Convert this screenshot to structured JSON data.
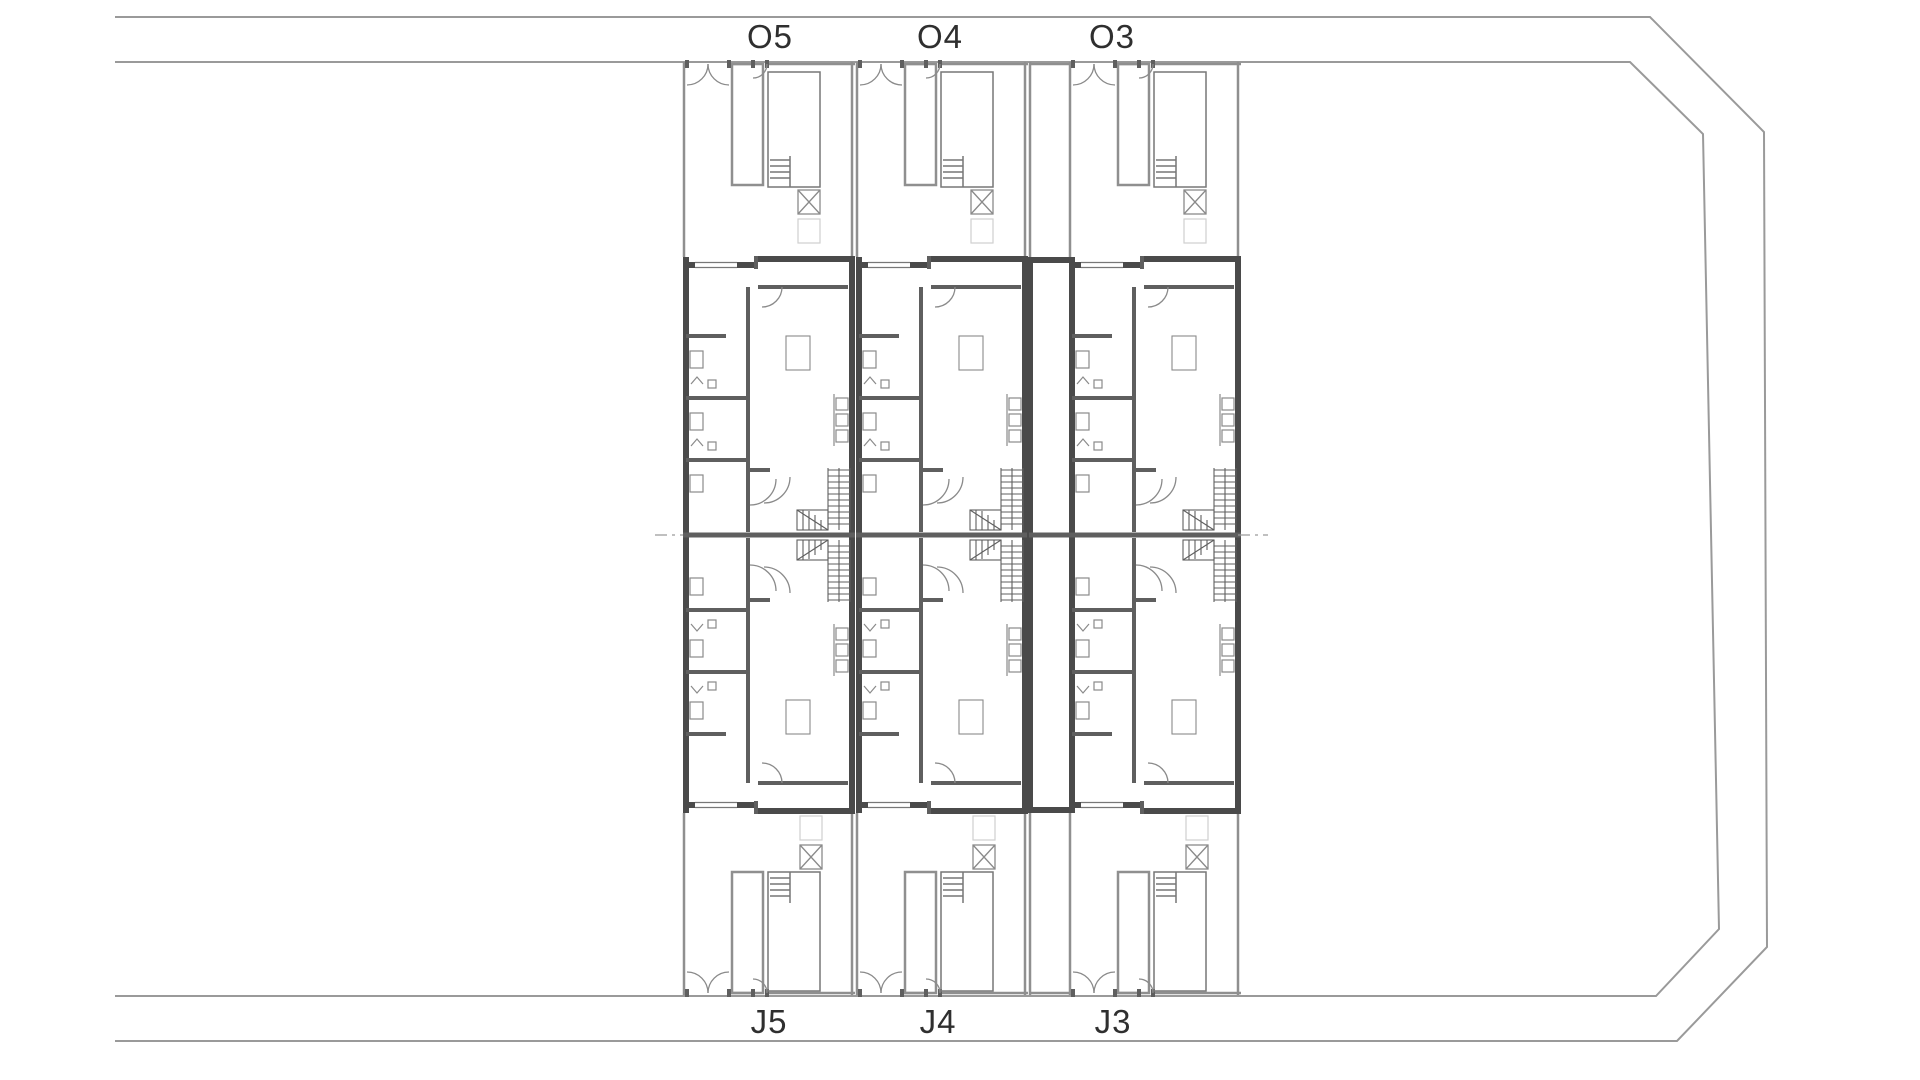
{
  "plan": {
    "kind": "architectural site and floor plan",
    "rows": {
      "street_side": "O row (top)",
      "garden_side": "J row (bottom)"
    }
  },
  "units": {
    "o5": "O5",
    "o4": "O4",
    "o3": "O3",
    "j5": "J5",
    "j4": "J4",
    "j3": "J3"
  },
  "colors": {
    "background": "#ffffff",
    "boundary": "#9a9a9a",
    "garden_wall": "#8f8f8f",
    "building_wall": "#4a4a4a",
    "interior_wall": "#5f5f5f",
    "pool_line": "#777777",
    "fixture_line": "#8a8a8a",
    "faint_line": "#cfcfcf",
    "label": "#2f2f2f"
  }
}
